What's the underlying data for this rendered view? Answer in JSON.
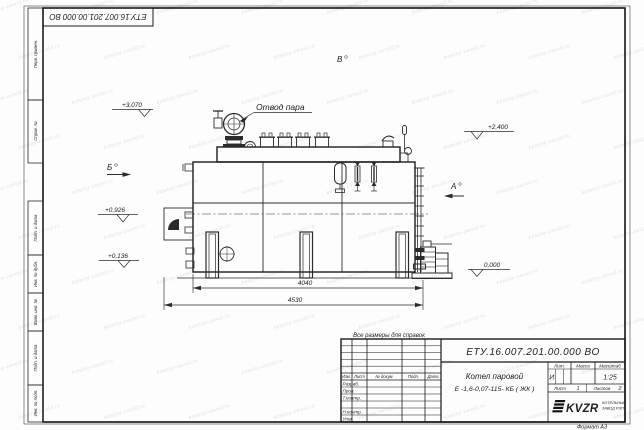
{
  "sheet": {
    "format_label": "Формат А3",
    "top_stamp_text": "ЕТУ.16.007.201.00.000  ВО",
    "reference_note": "Все размеры для справок"
  },
  "margin_labels": {
    "perv_primen": "Перв. примен.",
    "sprav_no": "Справ. №",
    "podp_data_upper": "Подп. и дата",
    "inv_no_dubl": "Инв. № дубл.",
    "vzam_inv_no": "Взам. инв. №",
    "podp_data_lower": "Подп. и дата",
    "inv_no_podl": "Инв. № подл."
  },
  "title_block": {
    "designation": "ЕТУ.16.007.201.00.000  ВО",
    "product_name_line1": "Котел паровой",
    "product_name_line2": "Е -1,6-0,07-115- КБ ( ЖК )",
    "col_izm": "Изм.",
    "col_list": "Лист",
    "col_doc": "№ докум.",
    "col_podp": "Подп.",
    "col_data": "Дата",
    "row_razrab": "Разраб.",
    "row_prov": "Пров.",
    "row_tkontr": "Т.контр.",
    "row_nkontr": "Н.контр.",
    "row_utv": "Утв.",
    "lit_header": "Лит.",
    "massa_header": "Масса",
    "masshtab_header": "Масштаб",
    "lit_value": "И",
    "masshtab_value": "1:25",
    "list_label": "Лист",
    "list_value": "1",
    "listov_label": "Листов",
    "listov_value": "2",
    "logo_text": "KVZR",
    "company_name_line1": "КОТЕЛЬНЫЙ",
    "company_name_line2": "ЗАВОД РЭП"
  },
  "drawing": {
    "steam_outlet_callout": "Отвод пара",
    "view_label_a": "А",
    "view_label_b": "Б",
    "view_label_v": "В",
    "elevation_3070": "+3,070",
    "elevation_2400": "+2,400",
    "elevation_0926": "+0,926",
    "elevation_0136": "+0,136",
    "elevation_0000": "0,000",
    "dim_inner": "4040",
    "dim_overall": "4530"
  },
  "watermark": {
    "text": "kotelny-zavod.ru"
  }
}
